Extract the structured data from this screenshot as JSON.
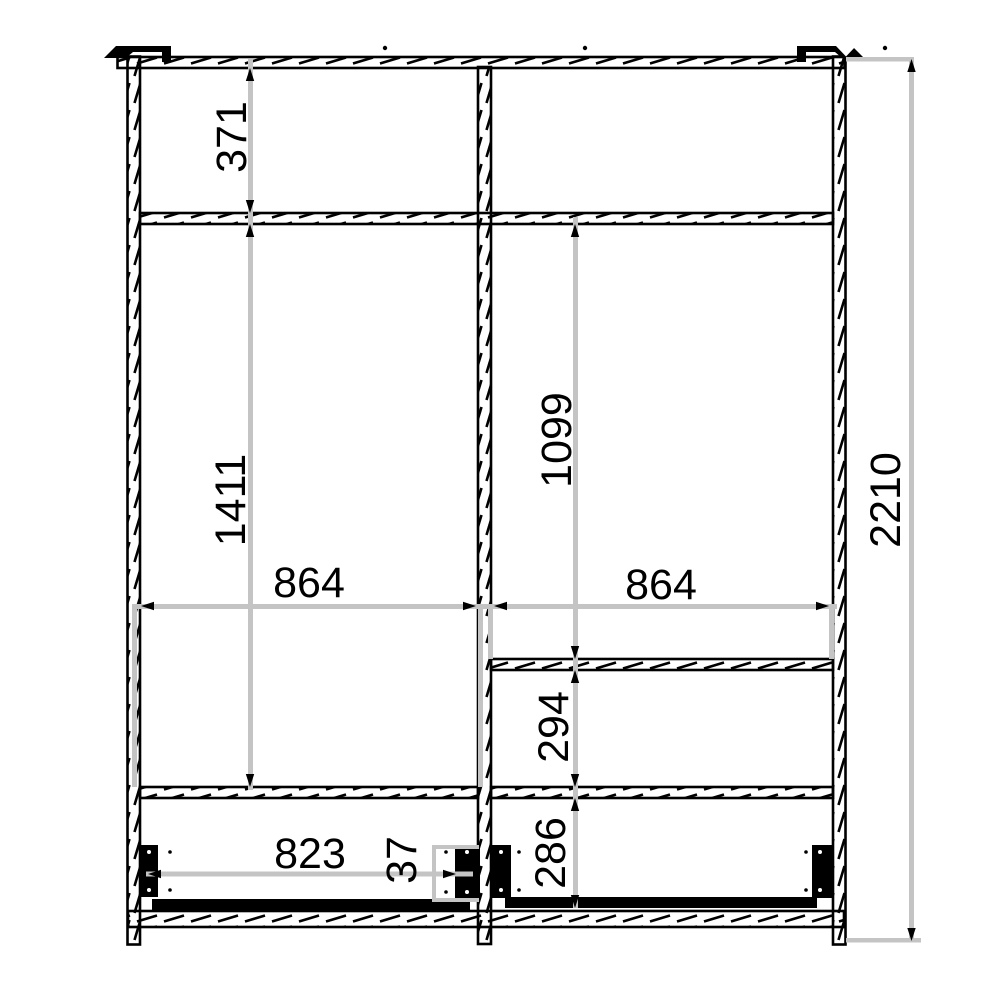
{
  "drawing": {
    "title": "Wardrobe cross-section technical drawing",
    "unit": "mm",
    "colors": {
      "outline": "#000000",
      "dimension_line": "#c4c4c4",
      "background": "#ffffff"
    },
    "dimensions": {
      "top_compartment_height": "371",
      "left_compartment_height": "1411",
      "right_compartment_height": "1099",
      "left_section_width": "864",
      "right_section_width": "864",
      "right_middle_compartment_height": "294",
      "right_bottom_compartment_height": "286",
      "left_drawer_width": "823",
      "drawer_gap": "37",
      "total_height": "2210"
    }
  }
}
